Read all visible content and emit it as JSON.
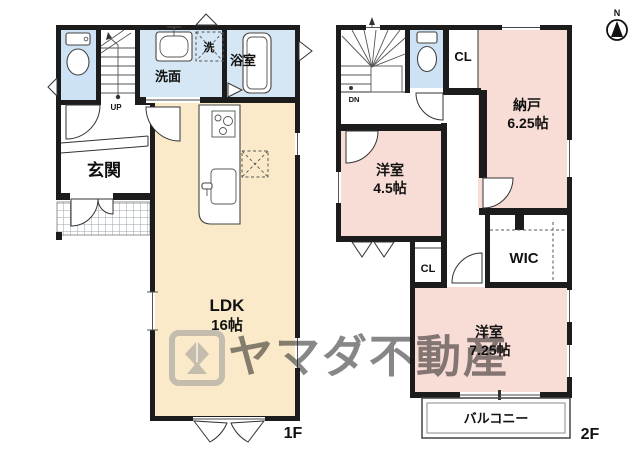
{
  "north": {
    "label": "N"
  },
  "watermark": {
    "brand": "ヤマダ不動産"
  },
  "colors": {
    "wall": "#1c1c1c",
    "water_room": "#d5e7f4",
    "toilet_room": "#cde2f4",
    "ldk_room": "#faeaca",
    "bedroom_pink": "#f8dcd6",
    "watermark_gray": "#8f8f8f"
  },
  "floor1": {
    "floor_label": "1F",
    "stairs": {
      "label": "UP"
    },
    "washroom": {
      "label": "洗面"
    },
    "washer": {
      "label": "洗"
    },
    "bathroom": {
      "label": "浴室"
    },
    "entrance": {
      "label": "玄関"
    },
    "ldk": {
      "label": "LDK",
      "area": "16帖"
    }
  },
  "floor2": {
    "floor_label": "2F",
    "stairs": {
      "label": "DN"
    },
    "closet_upper": {
      "label": "CL"
    },
    "storage": {
      "label": "納戸",
      "area": "6.25帖"
    },
    "bedroom_small": {
      "label": "洋室",
      "area": "4.5帖"
    },
    "wic": {
      "label": "WIC"
    },
    "closet_mid": {
      "label": "CL"
    },
    "bedroom_large": {
      "label": "洋室",
      "area": "7.25帖"
    },
    "balcony": {
      "label": "バルコニー"
    }
  }
}
